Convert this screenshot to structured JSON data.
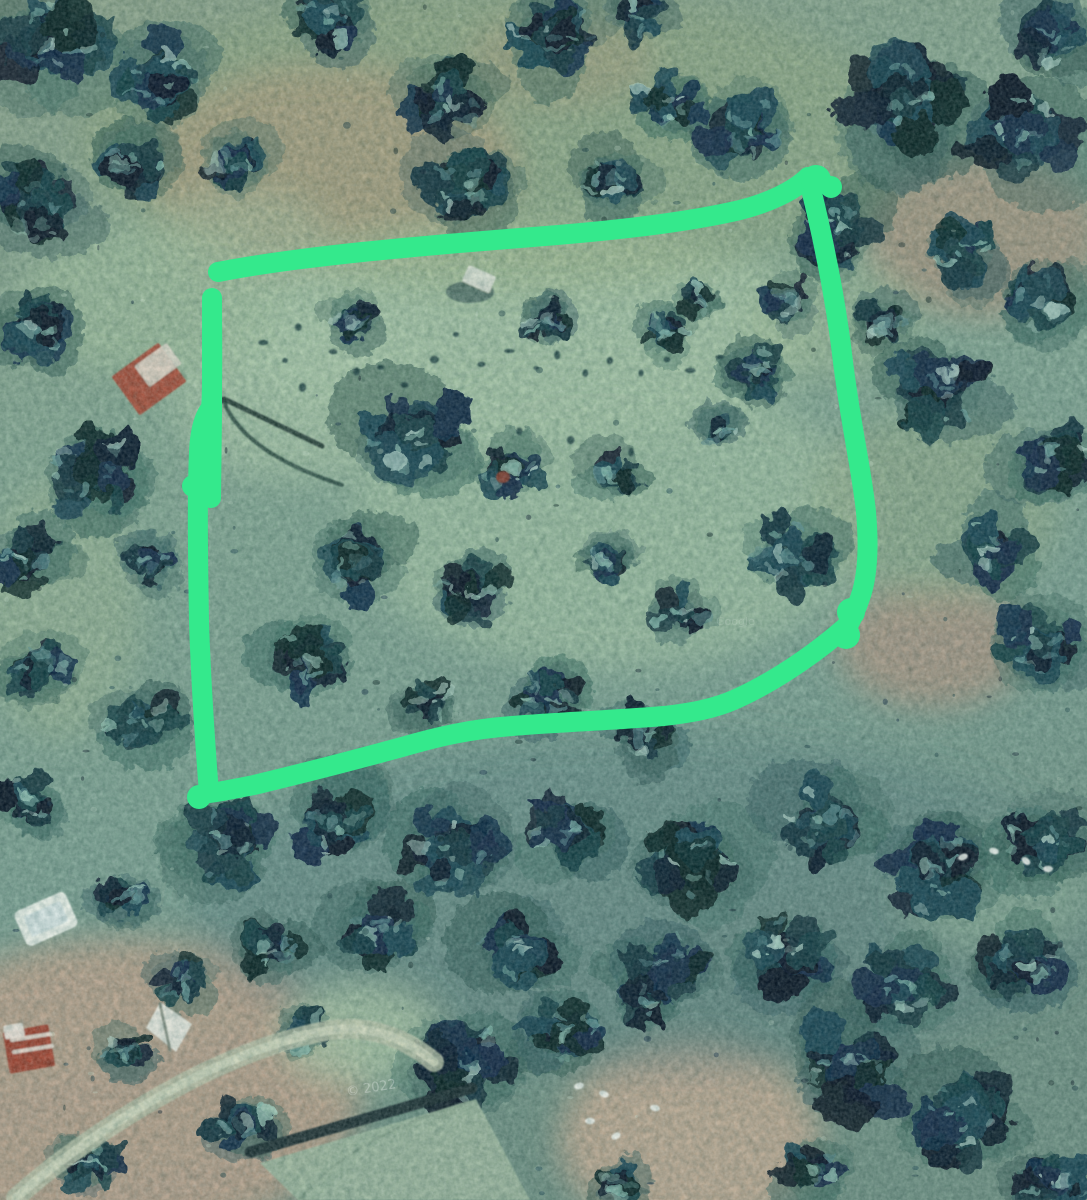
{
  "scene": {
    "type": "satellite-aerial-photo",
    "description": "Aerial/satellite view of wooded terrain with a thick hand-drawn bright green outline marking a roughly rectangular land parcel; scattered tree canopy, dirt patches, a few small rooftops and roads below",
    "seed": 20,
    "watermarks": [
      {
        "text": "© 2022"
      },
      {
        "text": "Google"
      }
    ],
    "terrain": {
      "base_top": "#8ba28a",
      "base_mid": "#84a793",
      "base_bottom": "#6f9184",
      "tree_darks": [
        "#0e2231",
        "#13304a",
        "#153a43",
        "#1a4449",
        "#0f2b2b",
        "#1d4a57",
        "#0a1c2a"
      ],
      "underbrush": [
        "#2e5a5e",
        "#35675f",
        "#2a5550",
        "#3c6a63"
      ],
      "fleck_lights": [
        "#6fa3a0",
        "#8bc0b2",
        "#a5d3c2",
        "#5d8f92",
        "#bcdcd0"
      ],
      "patches": [
        [
          330,
          165,
          185,
          100,
          "#b8937f",
          0.75
        ],
        [
          560,
          60,
          95,
          45,
          "#b8937f",
          0.45
        ],
        [
          985,
          235,
          120,
          80,
          "#b48f7c",
          0.6
        ],
        [
          933,
          645,
          95,
          62,
          "#b8937f",
          0.65
        ],
        [
          120,
          1090,
          240,
          150,
          "#c2a28c",
          0.8
        ],
        [
          690,
          1140,
          130,
          95,
          "#c6ab94",
          0.85
        ],
        [
          520,
          330,
          300,
          110,
          "#a9c6a8",
          0.8
        ],
        [
          610,
          520,
          260,
          150,
          "#a3c2a4",
          0.7
        ],
        [
          300,
          395,
          130,
          85,
          "#a9c6a8",
          0.7
        ],
        [
          150,
          300,
          130,
          75,
          "#9fbd9d",
          0.7
        ],
        [
          935,
          505,
          125,
          95,
          "#93ac8b",
          0.6
        ],
        [
          1000,
          893,
          95,
          60,
          "#a3c2a0",
          0.75
        ],
        [
          500,
          140,
          420,
          150,
          "#97a97e",
          0.4
        ],
        [
          650,
          905,
          460,
          170,
          "#47707a",
          0.3
        ],
        [
          360,
          1035,
          80,
          50,
          "#a9c3a4",
          0.85
        ],
        [
          60,
          610,
          80,
          130,
          "#9cb795",
          0.55
        ],
        [
          240,
          240,
          90,
          50,
          "#a3bb9b",
          0.6
        ],
        [
          830,
          320,
          90,
          60,
          "#9eb893",
          0.5
        ]
      ],
      "clusters": [
        [
          50,
          40,
          55
        ],
        [
          160,
          75,
          48
        ],
        [
          330,
          22,
          36
        ],
        [
          445,
          100,
          44
        ],
        [
          560,
          35,
          48
        ],
        [
          640,
          15,
          30
        ],
        [
          665,
          105,
          40
        ],
        [
          30,
          205,
          50
        ],
        [
          130,
          168,
          36
        ],
        [
          235,
          160,
          36
        ],
        [
          470,
          182,
          50
        ],
        [
          610,
          185,
          38
        ],
        [
          745,
          130,
          46
        ],
        [
          905,
          100,
          65
        ],
        [
          1020,
          135,
          55
        ],
        [
          1062,
          40,
          40
        ],
        [
          840,
          228,
          44
        ],
        [
          962,
          252,
          40
        ],
        [
          1048,
          300,
          45
        ],
        [
          884,
          320,
          28
        ],
        [
          940,
          390,
          50
        ],
        [
          1052,
          452,
          45
        ],
        [
          992,
          548,
          40
        ],
        [
          1042,
          645,
          45
        ],
        [
          35,
          332,
          44
        ],
        [
          92,
          470,
          55
        ],
        [
          25,
          562,
          40
        ],
        [
          150,
          560,
          28
        ],
        [
          42,
          662,
          38
        ],
        [
          140,
          722,
          40
        ],
        [
          30,
          800,
          34
        ],
        [
          232,
          842,
          50
        ],
        [
          120,
          900,
          30
        ],
        [
          352,
          322,
          24
        ],
        [
          548,
          320,
          28
        ],
        [
          662,
          332,
          28
        ],
        [
          700,
          298,
          22
        ],
        [
          786,
          302,
          26
        ],
        [
          762,
          372,
          34
        ],
        [
          415,
          432,
          55
        ],
        [
          512,
          468,
          34
        ],
        [
          612,
          472,
          28
        ],
        [
          722,
          432,
          24
        ],
        [
          352,
          562,
          44
        ],
        [
          472,
          592,
          38
        ],
        [
          602,
          562,
          28
        ],
        [
          792,
          556,
          46
        ],
        [
          682,
          612,
          28
        ],
        [
          302,
          662,
          40
        ],
        [
          552,
          702,
          34
        ],
        [
          642,
          732,
          34
        ],
        [
          432,
          702,
          28
        ],
        [
          332,
          822,
          46
        ],
        [
          452,
          852,
          50
        ],
        [
          572,
          832,
          44
        ],
        [
          692,
          862,
          55
        ],
        [
          822,
          822,
          50
        ],
        [
          932,
          872,
          55
        ],
        [
          1042,
          842,
          45
        ],
        [
          382,
          932,
          45
        ],
        [
          522,
          952,
          50
        ],
        [
          662,
          962,
          45
        ],
        [
          792,
          952,
          50
        ],
        [
          902,
          982,
          45
        ],
        [
          1022,
          962,
          45
        ],
        [
          272,
          952,
          34
        ],
        [
          122,
          1052,
          28
        ],
        [
          242,
          1122,
          34
        ],
        [
          92,
          1162,
          30
        ],
        [
          302,
          1032,
          28
        ],
        [
          462,
          1062,
          55
        ],
        [
          562,
          1032,
          40
        ],
        [
          645,
          1002,
          32
        ],
        [
          852,
          1062,
          60
        ],
        [
          962,
          1122,
          55
        ],
        [
          1052,
          1182,
          40
        ],
        [
          812,
          1172,
          34
        ],
        [
          622,
          1182,
          28
        ],
        [
          182,
          982,
          28
        ]
      ],
      "orchard_dots": [
        [
          262,
          342
        ],
        [
          287,
          364
        ],
        [
          306,
          386
        ],
        [
          334,
          353
        ],
        [
          357,
          373
        ],
        [
          300,
          331
        ],
        [
          382,
          366
        ],
        [
          408,
          387
        ],
        [
          433,
          357
        ],
        [
          458,
          338
        ],
        [
          483,
          368
        ],
        [
          509,
          349
        ],
        [
          534,
          372
        ],
        [
          560,
          355
        ],
        [
          586,
          375
        ],
        [
          612,
          357
        ],
        [
          639,
          373
        ],
        [
          665,
          356
        ],
        [
          692,
          374
        ],
        [
          719,
          359
        ],
        [
          746,
          373
        ],
        [
          516,
          432
        ],
        [
          574,
          441
        ],
        [
          634,
          452
        ]
      ],
      "white_specks": [
        [
          963,
          857,
          -20
        ],
        [
          994,
          851,
          15
        ],
        [
          1026,
          861,
          40
        ],
        [
          1048,
          869,
          0
        ],
        [
          579,
          1086,
          -15
        ],
        [
          604,
          1094,
          20
        ],
        [
          590,
          1121,
          0
        ],
        [
          616,
          1136,
          -30
        ],
        [
          655,
          1108,
          10
        ]
      ],
      "scatter_dark": 150,
      "scatter_light": 45
    },
    "features": [
      {
        "kind": "path",
        "name": "dirt-road",
        "d": "M 16 1198 C 60 1158 122 1116 182 1084 C 232 1058 282 1038 332 1030 C 370 1025 406 1038 434 1062",
        "stroke": "#b5bfa7",
        "sw": 20,
        "op": 0.85
      },
      {
        "kind": "path",
        "name": "dirt-road-center",
        "d": "M 16 1198 C 60 1158 122 1116 182 1084 C 232 1058 282 1038 332 1030 C 370 1025 406 1038 434 1062",
        "stroke": "#ced6bd",
        "sw": 9,
        "op": 0.9
      },
      {
        "kind": "ellipse",
        "name": "shed-shadow",
        "cx": 470,
        "cy": 292,
        "rx": 24,
        "ry": 11,
        "fill": "#1c3a40",
        "op": 0.5
      },
      {
        "kind": "rect",
        "name": "small-shed",
        "x": 464,
        "y": 270,
        "w": 30,
        "h": 18,
        "rot": 24,
        "fill": "#dde2d6",
        "op": 0.9
      },
      {
        "kind": "rect",
        "name": "red-roof-house",
        "x": 120,
        "y": 355,
        "w": 58,
        "h": 48,
        "rot": -36,
        "fill": "#a8503c",
        "op": 0.95
      },
      {
        "kind": "rect",
        "name": "red-roof-house-panel",
        "x": 138,
        "y": 352,
        "w": 40,
        "h": 26,
        "rot": -36,
        "fill": "#ddd8ca",
        "op": 0.92
      },
      {
        "kind": "path",
        "name": "fence-line",
        "d": "M 206 412 L 224 399 L 322 446",
        "stroke": "#14322f",
        "sw": 5,
        "op": 0.85
      },
      {
        "kind": "path",
        "name": "fence-line-2",
        "d": "M 224 401 C 230 420 250 442 281 459 C 302 471 324 479 342 485",
        "stroke": "#14322f",
        "sw": 4,
        "op": 0.7
      },
      {
        "kind": "ellipse",
        "name": "red-ground-spot",
        "cx": 503,
        "cy": 477,
        "rx": 7,
        "ry": 6,
        "fill": "#8a4434",
        "op": 0.9
      },
      {
        "kind": "rect",
        "name": "white-roof-structure",
        "x": 18,
        "y": 900,
        "w": 56,
        "h": 38,
        "rot": -24,
        "r": 6,
        "fill": "#eef2ea",
        "op": 0.95
      },
      {
        "kind": "rect",
        "name": "white-roof-inner",
        "x": 26,
        "y": 908,
        "w": 40,
        "h": 22,
        "rot": -24,
        "fill": "#cfe0df",
        "op": 0.8
      },
      {
        "kind": "rect",
        "name": "red-white-roof-house",
        "x": 6,
        "y": 1028,
        "w": 46,
        "h": 42,
        "rot": -10,
        "fill": "#a04531",
        "op": 0.95
      },
      {
        "kind": "path",
        "name": "roof-ridges",
        "d": "M 12 1040 L 50 1034 M 14 1052 L 52 1046",
        "stroke": "#e5e1d6",
        "sw": 4,
        "op": 0.9
      },
      {
        "kind": "rect",
        "name": "roof-gable",
        "x": 4,
        "y": 1024,
        "w": 20,
        "h": 14,
        "rot": -10,
        "fill": "#e8e4da",
        "op": 0.95
      },
      {
        "kind": "poly",
        "name": "white-gable-roof",
        "pts": "160,1002 192,1024 176,1052 146,1028",
        "fill": "#e6e8de",
        "op": 0.95
      },
      {
        "kind": "path",
        "name": "roof-fold",
        "d": "M 160 1004 L 170 1050",
        "stroke": "#6a7a6e",
        "sw": 3,
        "op": 0.8
      },
      {
        "kind": "path",
        "name": "building-edge",
        "d": "M 250 1152 L 472 1088",
        "stroke": "#1e3136",
        "sw": 11,
        "op": 0.95
      },
      {
        "kind": "poly",
        "name": "large-building-roof",
        "pts": "260,1163 476,1099 530,1200 298,1200",
        "fill": "#9cb69e",
        "op": 0.95
      },
      {
        "kind": "path",
        "name": "roof-ridge-line",
        "d": "M 300 1200 C 330 1160 390 1125 470 1102",
        "stroke": "#8aa58e",
        "sw": 3,
        "op": 0.8
      }
    ]
  },
  "annotation": {
    "label": "hand-drawn parcel boundary",
    "color": "#34e98c",
    "stroke_width": 20,
    "outline_path": "M 218 272 C 300 256 420 246 520 238 C 600 232 680 224 740 210 C 768 203 794 191 808 177 C 822 232 836 300 843 362 C 851 426 862 472 866 512 C 869 546 868 576 860 598 C 856 610 852 618 849 624 C 820 650 778 680 736 699 C 714 709 690 713 664 716 C 618 720 560 722 512 726 C 472 729 440 736 402 747 C 358 759 300 774 254 785 C 234 789 218 792 209 793 C 205 742 201 682 199 622 C 198 560 197 500 199 452 C 200 430 204 416 211 408 C 213 390 212 340 212 300",
    "thick_segments": [
      {
        "d": "M 212 298 L 212 414 L 211 498",
        "w": 20
      }
    ],
    "knobs": [
      [
        816,
        180,
        15
      ],
      [
        831,
        187,
        11
      ],
      [
        851,
        612,
        14
      ],
      [
        846,
        635,
        14
      ],
      [
        199,
        797,
        12
      ],
      [
        193,
        486,
        11
      ]
    ]
  }
}
